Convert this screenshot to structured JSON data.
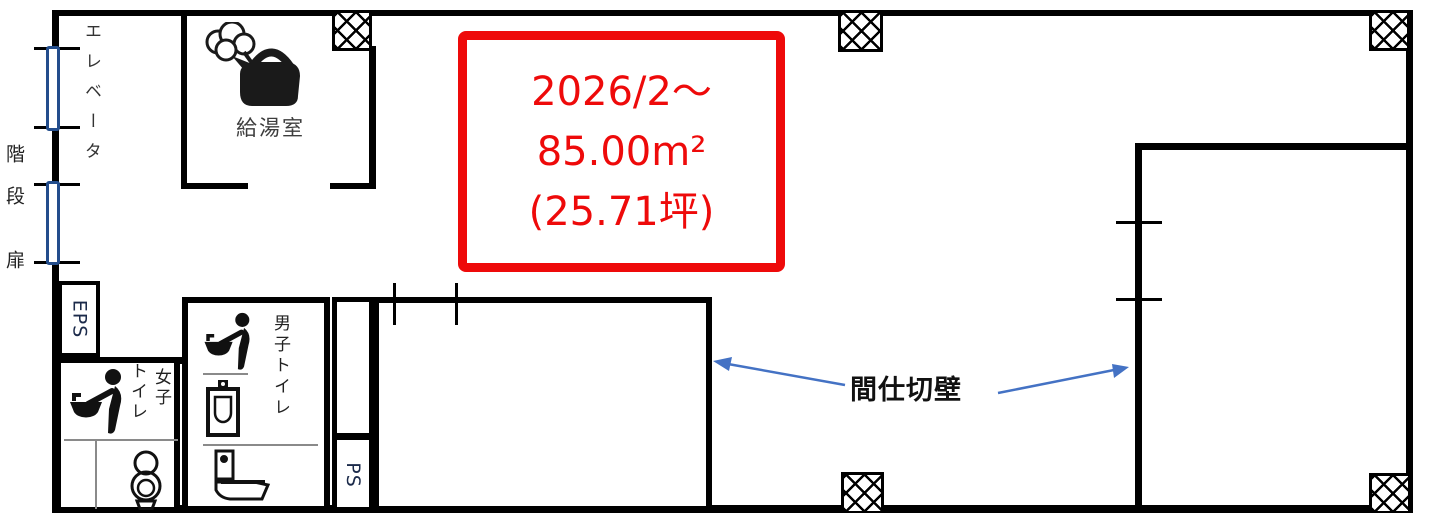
{
  "plan": {
    "highlight_box": {
      "line1": "2026/2〜",
      "line2": "85.00m²",
      "line3": "(25.71坪)"
    },
    "left_labels": {
      "elevator": "エレベータ",
      "stairs": "階段",
      "door": "扉"
    },
    "rooms": {
      "kitchenette": {
        "label": "給湯室"
      },
      "eps": {
        "label": "EPS"
      },
      "ps": {
        "label": "PS"
      },
      "mens_toilet": {
        "label": "男子トイレ"
      },
      "womens_toilet": {
        "label_col_right": "女子",
        "label_col_left": "トイレ"
      }
    },
    "annotations": {
      "partition_wall": "間仕切壁"
    },
    "colors": {
      "wall": "#000000",
      "highlight_red": "#ee0a0a",
      "door_blue": "#234d8c",
      "arrow_blue": "#4472c4"
    }
  }
}
